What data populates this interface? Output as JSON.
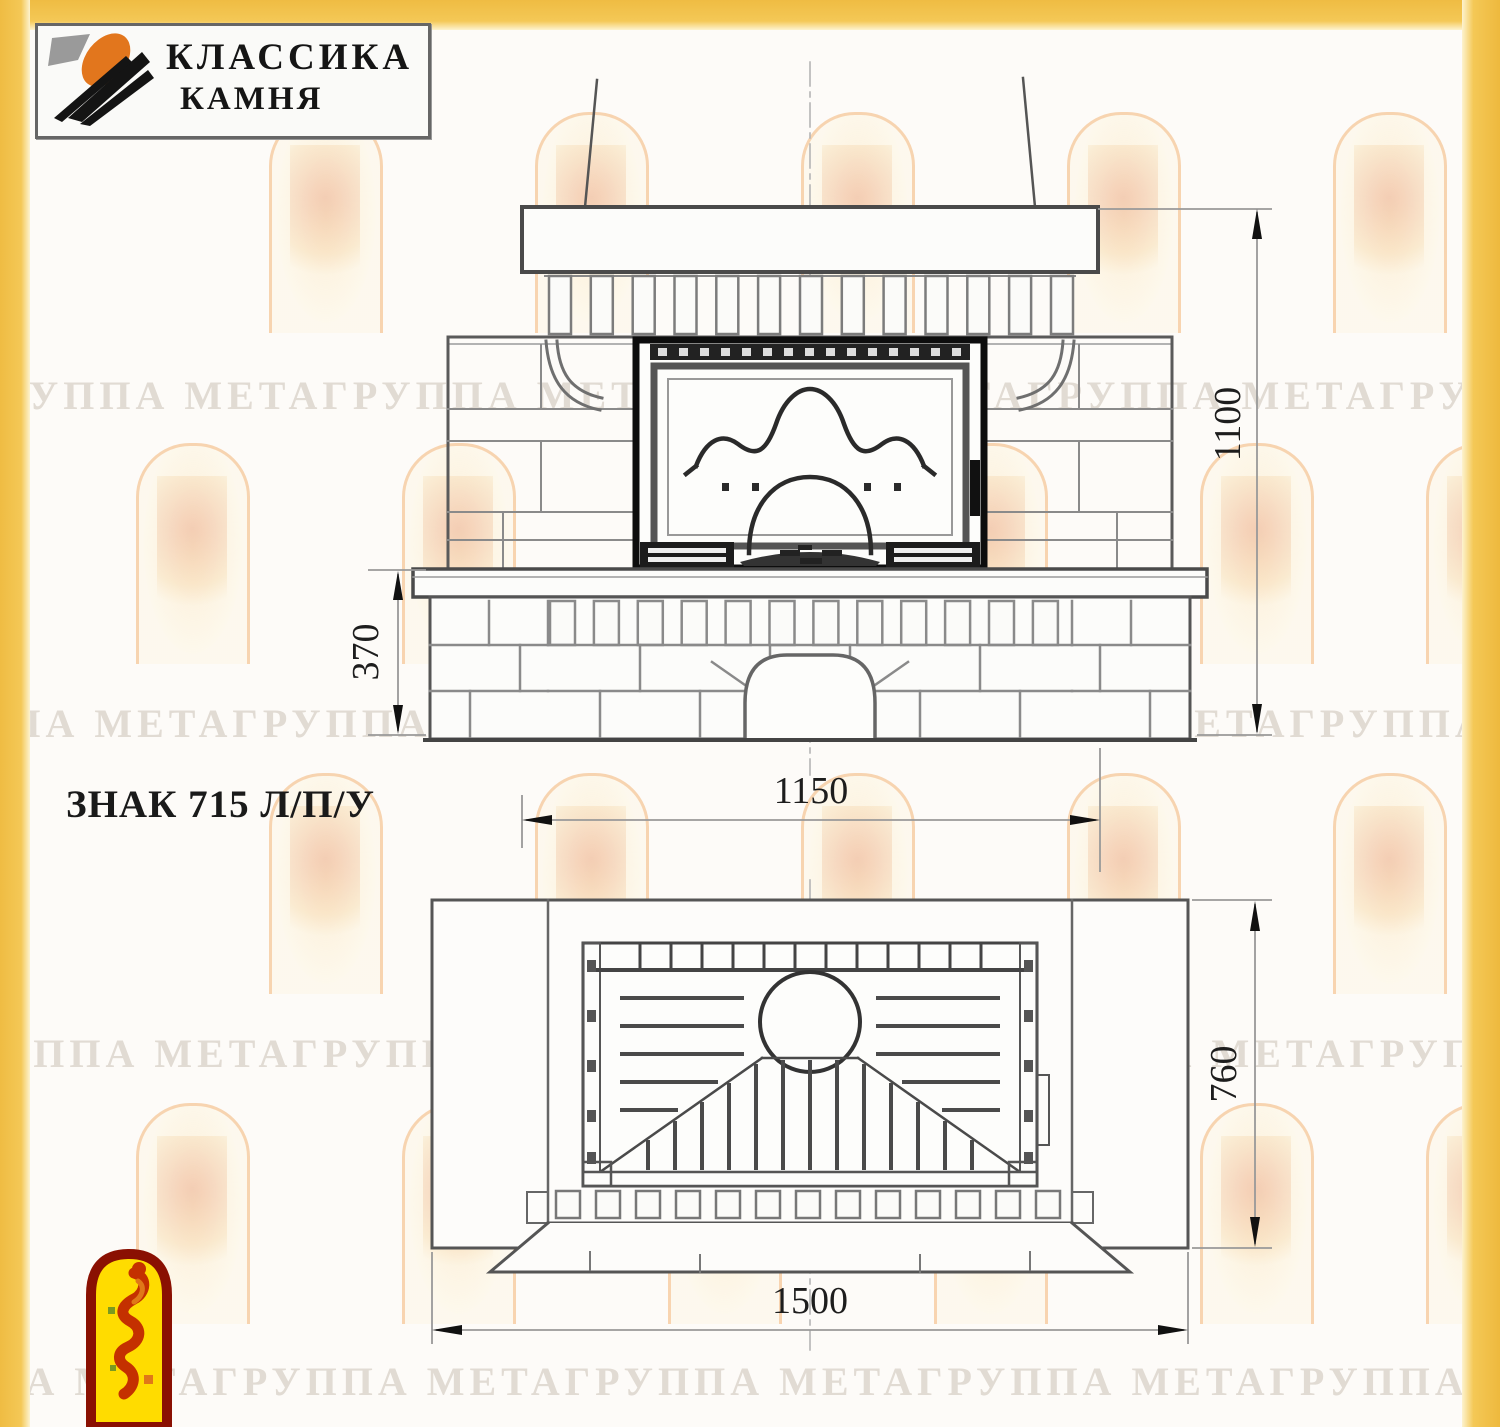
{
  "frame": {
    "color": "#F3C44F"
  },
  "brand": {
    "name_line1": "КЛАССИКА",
    "name_line2": "КАМНЯ"
  },
  "model": {
    "label": "ЗНАК 715 Л/П/У"
  },
  "dimensions": {
    "front": {
      "overall_height_mm": "1100",
      "plinth_height_mm": "370",
      "mantel_width_mm": "1150"
    },
    "plan": {
      "depth_mm": "760",
      "overall_width_mm": "1500"
    }
  },
  "watermark": {
    "text": "ГРУППА МЕТАГРУППА МЕТАГРУППА МЕТАГРУППА МЕТАГРУППА МЕТА"
  }
}
